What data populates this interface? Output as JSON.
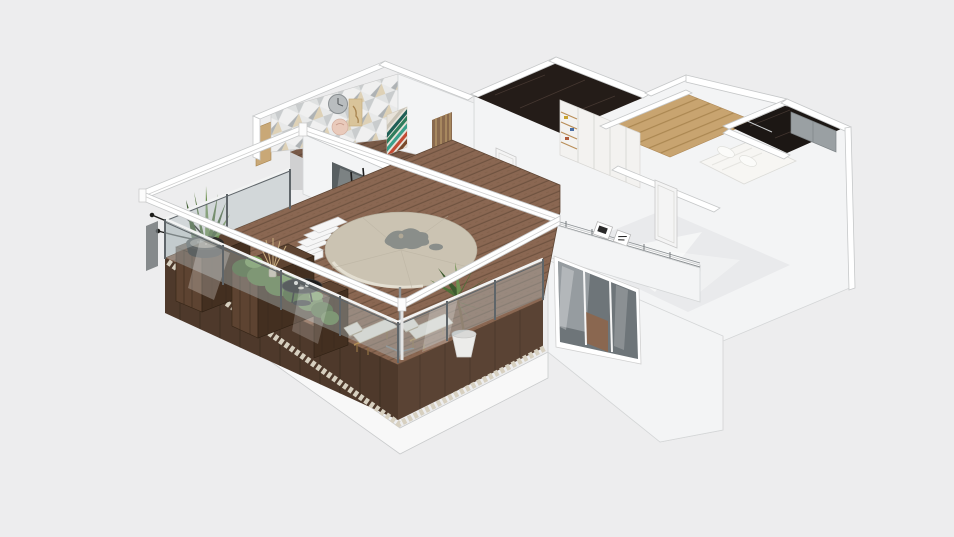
{
  "scene": {
    "description": "Isometric 3D dollhouse render of an apartment floor plan with a large furnished wood-deck terrace, on a plain light-gray background",
    "view": "isometric bird's-eye",
    "visible_text": "",
    "objects": [
      "terrace wood deck",
      "glass balustrade with metal posts",
      "white pergola frame",
      "beige patio umbrella with leaf shadow",
      "two sun loungers",
      "round black coffee table with cups",
      "wooden planter boxes",
      "green hedge plants",
      "black bowl with snake plant and twigs",
      "dried grass vase",
      "potted palm in white pot",
      "white outdoor steps",
      "sliding glass doors",
      "black dining chair",
      "television",
      "gold artwork",
      "curtain",
      "triangle mosaic accent wall",
      "wall clock",
      "pink decorative plate",
      "bird artwork",
      "striped abstract artwork",
      "timber slat partition",
      "kitchen cabinet glimpse",
      "dark marble bathroom floor",
      "white wardrobe with open shelves",
      "interior white door",
      "hallway wood floor",
      "second dark marble bathroom",
      "gray wardrobe",
      "bedroom with glossy floor",
      "bedroom door",
      "gallery rail with picture frames",
      "bed with white duvet and pillows",
      "tall exterior white walls",
      "three-pane window",
      "gravel border strip",
      "white plinth base"
    ]
  },
  "colors": {
    "bg": "#ededee",
    "plinth": "#f8f8f8",
    "gravel": "#d7d0c0",
    "wall_top": "#ffffff",
    "wall_front": "#f3f4f5",
    "wall_side": "#eef0f1",
    "wall_edge": "#c9cbcc",
    "deck": "#8a6752",
    "deck_line": "#6f5340",
    "skirt": "#4e392b",
    "skirt2": "#5a4334",
    "planter": "#5d4331",
    "planter_dark": "#432f20",
    "hedge": "#5d7f43",
    "hedge_dark": "#46632f",
    "hedge_light": "#79a05b",
    "leaf": "#4f7038",
    "leaf_dark": "#3c5a2e",
    "leaf_light": "#6d9150",
    "grass": "#c9ae80",
    "table": "#1c1c1c",
    "cushion": "#f0ede3",
    "cushion_edge": "#cfc8b4",
    "wood_frame": "#b08c57",
    "pot": "#ececea",
    "bowl": "#222220",
    "parasol": "#cbc3b2",
    "parasol_hi": "#e9e4d7",
    "blob": "#8a8e8a",
    "glass": "#aeb9bd",
    "metal": "#5f6569",
    "stair": "#f6f6f6",
    "wallpaper_bg": "#f0f0f0",
    "tri1": "#c9cccd",
    "tri2": "#dfe1e1",
    "tri3": "#aeb2b4",
    "tri4": "#d9c9a8",
    "clock": "#b9bdbf",
    "plate": "#e9cabb",
    "bird": "#d9c49a",
    "art_green": "#2f7d5c",
    "art_teal": "#3aa08a",
    "art_red": "#c24b33",
    "art_brown": "#7a4a2a",
    "art_white": "#e8e3da",
    "art_dark": "#1f5f56",
    "slat": "#8a6a4e",
    "slat_line": "#c4a670",
    "marble": "#241c18",
    "marble2": "#1c1714",
    "vein": "#5d4b42",
    "wardrobe": "#f3f2f0",
    "shelf": "#b98e58",
    "gray_wd": "#9aa0a3",
    "corridor": "#c8a470",
    "corridor_line": "#a9854f",
    "gloss": "#e9eaec",
    "bed": "#f7f6f3",
    "bed_edge": "#dcdcd8",
    "door": "#f4f4f4",
    "door_edge": "#c9c9c9",
    "win_dark": "#6e7579",
    "win_light": "#a6adb0",
    "glass_door": "#4b5154",
    "gold": "#c9a22e",
    "tv": "#0f0f10"
  }
}
